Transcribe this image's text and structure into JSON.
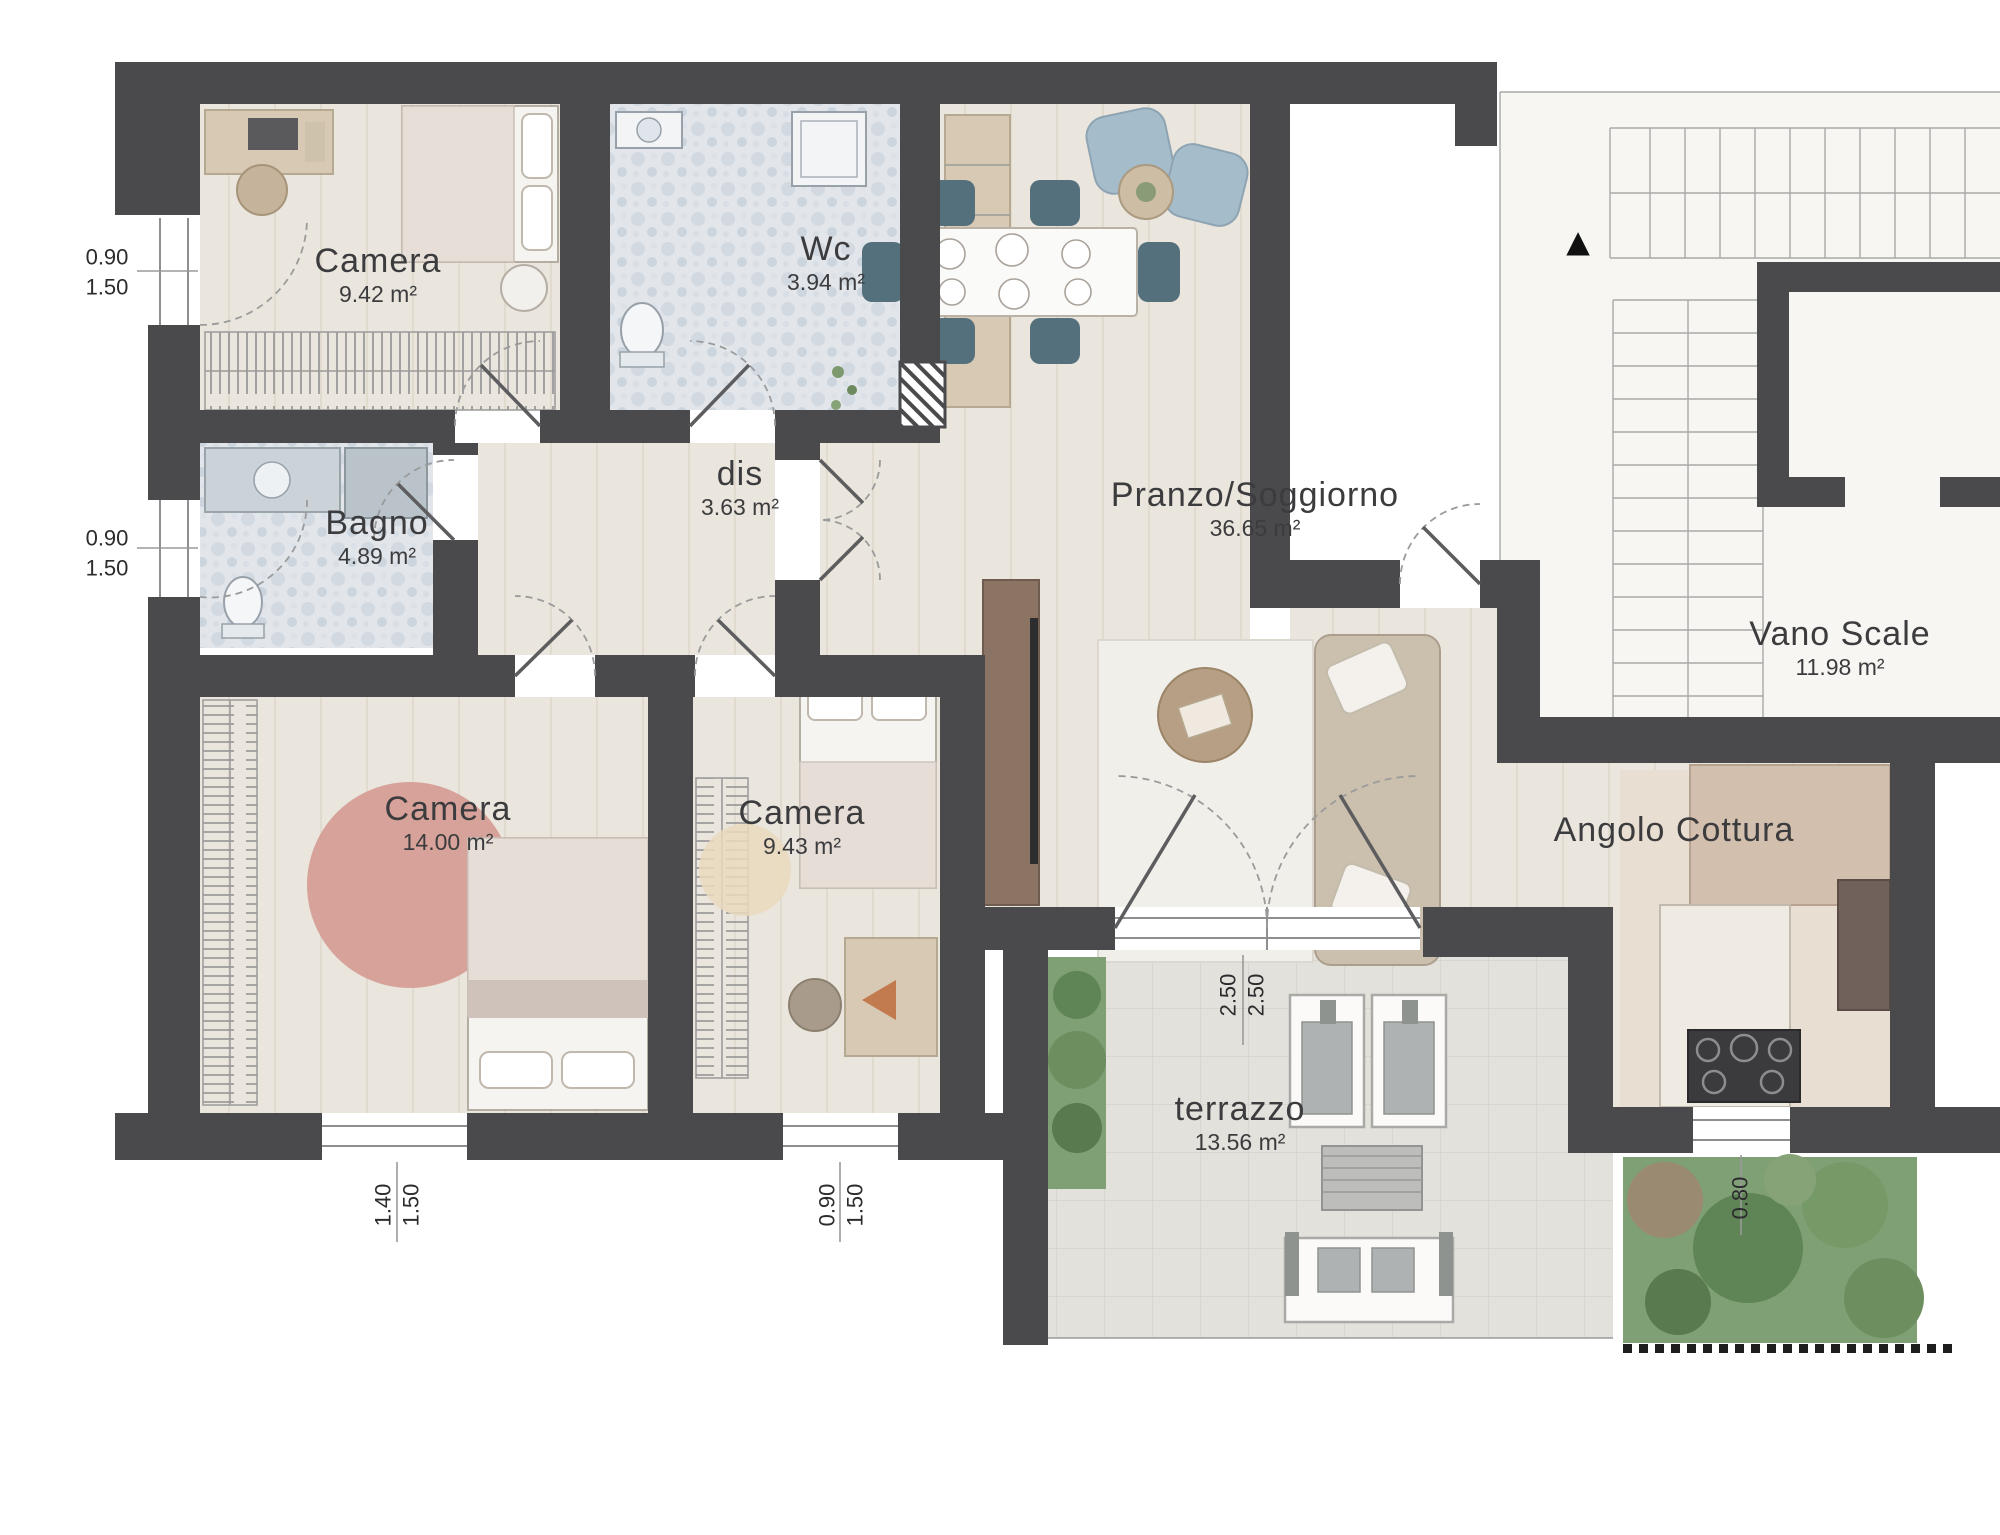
{
  "title": "Apartment floor plan",
  "rooms": {
    "camera_nord": {
      "label": "Camera",
      "area": "9.42 m²"
    },
    "wc": {
      "label": "Wc",
      "area": "3.94 m²"
    },
    "disimpegno": {
      "label": "dis",
      "area": "3.63 m²"
    },
    "bagno": {
      "label": "Bagno",
      "area": "4.89 m²"
    },
    "camera_ovest": {
      "label": "Camera",
      "area": "14.00 m²"
    },
    "camera_sud": {
      "label": "Camera",
      "area": "9.43 m²"
    },
    "pranzo_soggiorno": {
      "label": "Pranzo/Soggiorno",
      "area": "36.65 m²"
    },
    "vano_scale": {
      "label": "Vano Scale",
      "area": "11.98 m²"
    },
    "angolo_cottura": {
      "label": "Angolo Cottura"
    },
    "terrazzo": {
      "label": "terrazzo",
      "area": "13.56 m²"
    }
  },
  "dimensions": {
    "left_window_top": [
      "0.90",
      "1.50"
    ],
    "left_window_bottom": [
      "0.90",
      "1.50"
    ],
    "camera_large_window": [
      "1.40",
      "1.50"
    ],
    "camera_small_window": [
      "0.90",
      "1.50"
    ],
    "terrace_door": [
      "2.50",
      "2.50"
    ],
    "kitchen_window": [
      "0.80"
    ]
  },
  "symbols": {
    "stairs_direction_arrow": "▲"
  },
  "colors": {
    "wall": "#4a4a4c",
    "text": "#3c3c3e",
    "line": "#9a9a9a",
    "wood": "#eae6de",
    "tile": "#e2e6eb",
    "terrace": "#e3e1db",
    "kitchen": "#e9ded2",
    "garden": "#7f9f74",
    "pink": "#d4988f",
    "tan": "#d8c9b4",
    "teal": "#54707c",
    "blue": "#a5bcca",
    "sofa": "#cbbfae",
    "tv": "#8b7463"
  }
}
